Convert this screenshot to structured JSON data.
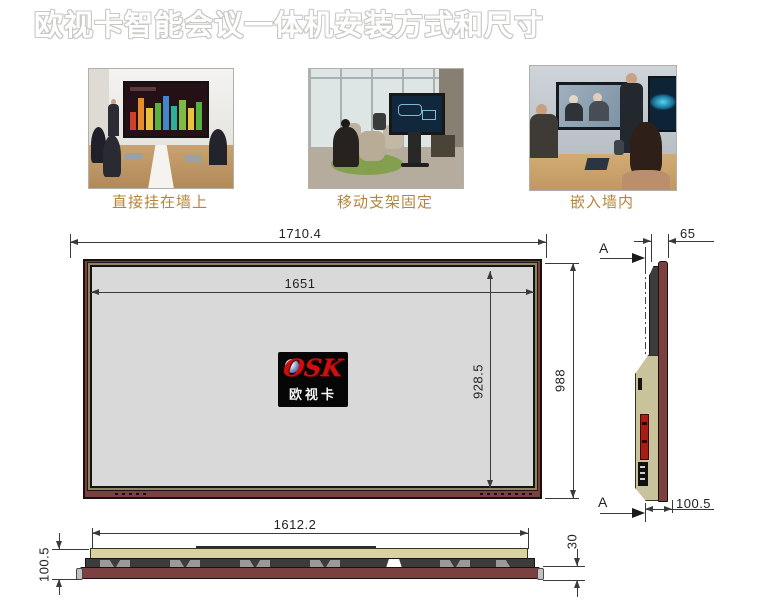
{
  "header": {
    "title": "欧视卡智能会议一体机安装方式和尺寸"
  },
  "photos": [
    {
      "caption": "直接挂在墙上"
    },
    {
      "caption": "移动支架固定"
    },
    {
      "caption": "嵌入墙内"
    }
  ],
  "logo": {
    "brand": "OSK",
    "name": "欧视卡"
  },
  "front_view": {
    "dims": {
      "outer_width": "1710.4",
      "screen_width": "1651",
      "screen_height": "928.5",
      "outer_height": "988"
    }
  },
  "side_view": {
    "section_top": "A",
    "section_bottom": "A",
    "dims": {
      "top_depth": "65",
      "total_depth": "100.5"
    }
  },
  "bottom_view": {
    "dims": {
      "back_width": "1612.2",
      "total_depth": "100.5",
      "front_depth": "30"
    }
  },
  "colors": {
    "frame_maroon": "#7b4141",
    "rear_tan": "#c9c39b",
    "screen_gray": "#d9d9d9",
    "caption_gold": "#b5853c",
    "logo_red": "#cf0e0e",
    "drawing_line": "#3a3a3a"
  }
}
